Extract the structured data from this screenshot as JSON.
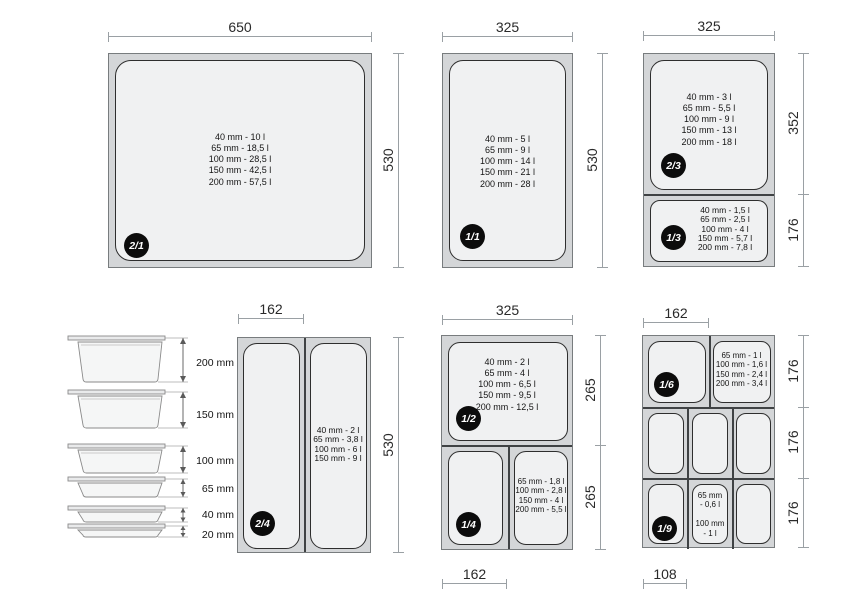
{
  "dims": {
    "w650": "650",
    "w325": "325",
    "w162": "162",
    "w108": "108",
    "h530": "530",
    "h352": "352",
    "h265": "265",
    "h176": "176"
  },
  "groups": {
    "gn21": {
      "badge": "2/1",
      "capacities": [
        "40 mm - 10 l",
        "65 mm - 18,5 l",
        "100 mm - 28,5 l",
        "150 mm - 42,5 l",
        "200 mm - 57,5 l"
      ]
    },
    "gn11": {
      "badge": "1/1",
      "capacities": [
        "40 mm - 5 l",
        "65 mm - 9 l",
        "100 mm - 14 l",
        "150 mm - 21 l",
        "200 mm - 28 l"
      ]
    },
    "gn23": {
      "badge": "2/3",
      "capacities": [
        "40 mm - 3 l",
        "65 mm - 5,5 l",
        "100 mm - 9 l",
        "150 mm - 13 l",
        "200 mm - 18 l"
      ]
    },
    "gn13": {
      "badge": "1/3",
      "capacities": [
        "40 mm - 1,5 l",
        "65 mm - 2,5 l",
        "100 mm - 4 l",
        "150 mm - 5,7 l",
        "200 mm - 7,8 l"
      ]
    },
    "gn24": {
      "badge": "2/4",
      "capacities": [
        "40 mm - 2 l",
        "65 mm - 3,8 l",
        "100 mm - 6 l",
        "150 mm - 9 l"
      ]
    },
    "gn12": {
      "badge": "1/2",
      "capacities": [
        "40 mm - 2 l",
        "65 mm - 4 l",
        "100 mm - 6,5 l",
        "150 mm - 9,5 l",
        "200 mm - 12,5 l"
      ]
    },
    "gn14": {
      "badge": "1/4",
      "capacities": [
        "65 mm - 1,8 l",
        "100 mm - 2,8 l",
        "150 mm - 4 l",
        "200 mm - 5,5 l"
      ]
    },
    "gn16": {
      "badge": "1/6",
      "capacities": [
        "65 mm - 1 l",
        "100 mm - 1,6 l",
        "150 mm - 2,4 l",
        "200 mm - 3,4 l"
      ]
    },
    "gn19": {
      "badge": "1/9",
      "capacities": [
        "65 mm",
        "- 0,6 l",
        "",
        "100 mm",
        "- 1 l"
      ]
    }
  },
  "depth_stack": {
    "labels": [
      "200 mm",
      "150 mm",
      "100 mm",
      "65 mm",
      "40 mm",
      "20 mm"
    ]
  },
  "colors": {
    "pan_body": "#d4d6d8",
    "pan_inner": "#f0f1f2",
    "dim_line": "#9aa0a4",
    "badge_bg": "#0c0c0c",
    "badge_text": "#ffffff"
  }
}
